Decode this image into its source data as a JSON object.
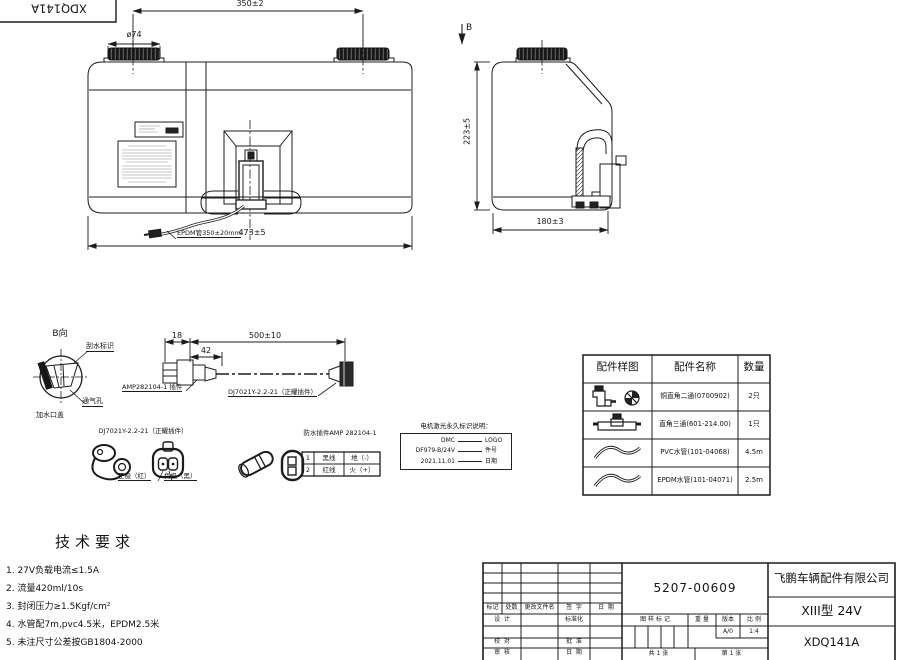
{
  "corner": {
    "code": "XDQ141A"
  },
  "front_view": {
    "dim_overall_top": "350±2",
    "dim_cap": "ø74",
    "view_arrow": "B",
    "hose_label": "EPDM管350±20mm",
    "dim_length": "473±5"
  },
  "side_view": {
    "dim_height": "223±5",
    "dim_width": "180±3"
  },
  "detail_b": {
    "title": "B向",
    "label_wiper": "刮水标识",
    "label_vent": "通气孔",
    "label_filler": "加水口盖"
  },
  "harness": {
    "dim_18": "18",
    "dim_42": "42",
    "dim_500": "500±10",
    "label_amp": "AMP282104-1 插件",
    "label_dj": "DJ7021Y-2.2-21（正耀插件）"
  },
  "connector_dj": {
    "title": "DJ7021Y-2.2-21（正耀插件）",
    "positive": "正极（红）",
    "negative": "负极（黑）"
  },
  "connector_amp": {
    "title": "防水插件AMP 282104-1",
    "pins": [
      {
        "no": "1",
        "wire": "黑线",
        "func": "地（-）"
      },
      {
        "no": "2",
        "wire": "红线",
        "func": "火（+）"
      }
    ]
  },
  "laser_marking": {
    "title": "电机激光永久标识说明：",
    "rows": [
      {
        "left": "DMC",
        "right": "LOGO"
      },
      {
        "left": "DF979-B/24V",
        "right": "件号"
      },
      {
        "left": "2021.11.01",
        "right": "日期"
      }
    ]
  },
  "parts_table": {
    "headers": [
      "配件样图",
      "配件名称",
      "数量"
    ],
    "rows": [
      {
        "icon": "elbow-fitting",
        "name": "铜直角二通(0700902)",
        "qty": "2只"
      },
      {
        "icon": "tee-fitting",
        "name": "直角三通(601-214.00)",
        "qty": "1只"
      },
      {
        "icon": "pvc-hose",
        "name": "PVC水管(101-04068)",
        "qty": "4.5m"
      },
      {
        "icon": "epdm-hose",
        "name": "EPDM水管(101-04071)",
        "qty": "2.5m"
      }
    ]
  },
  "tech_req": {
    "title": "技术要求",
    "items": [
      "1. 27V负载电流≤1.5A",
      "2. 流量420ml/10s",
      "3. 封闭压力≥1.5Kgf/cm²",
      "4. 水管配7m,pvc4.5米，EPDM2.5米",
      "5. 未注尺寸公差按GB1804-2000"
    ]
  },
  "title_block": {
    "drawing_no": "5207-00609",
    "company": "飞鹏车辆配件有限公司",
    "model": "XIII型 24V",
    "part_code": "XDQ141A",
    "rev_headers": [
      "标记",
      "处数",
      "更改文件名",
      "签  字",
      "日  期"
    ],
    "design": "设  计",
    "standardize": "标准化",
    "check": "校  对",
    "approve": "批  准",
    "review": "审  核",
    "date": "日  期",
    "mark_header": "图 样 标 记",
    "weight": "重 量",
    "version": "版本",
    "scale": "比 例",
    "version_val": "A/0",
    "scale_val": "1:4",
    "sheet_total": "共 1 张",
    "sheet_no": "第 1 张"
  }
}
